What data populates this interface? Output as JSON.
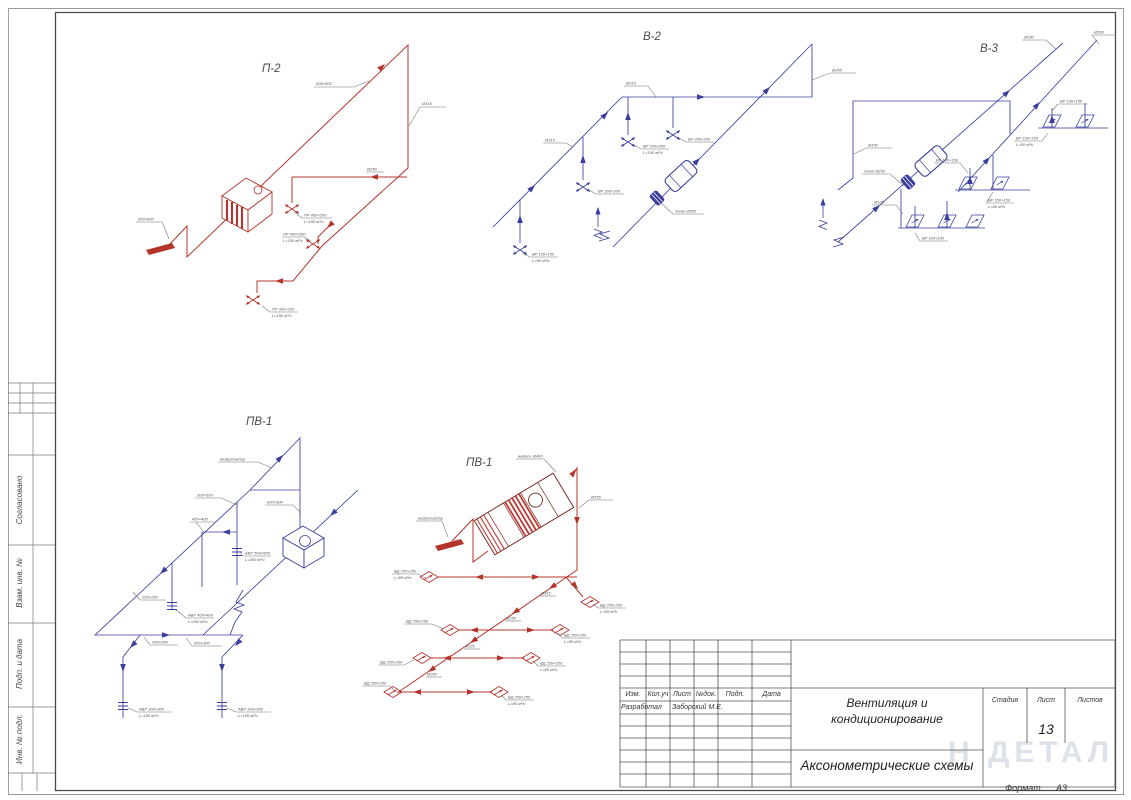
{
  "sheet": {
    "watermark": "Н ДЕТАЛ",
    "format_label": "Формат",
    "format_value": "А3"
  },
  "left_strip": {
    "soglasovano": "Согласовано",
    "vzam_inv": "Взам. инв. №",
    "podp_data": "Подп. и дата",
    "inv_podl": "Инв. № подл."
  },
  "title_block": {
    "rev_headers": [
      "Изм.",
      "Кол.уч",
      "Лист",
      "№док.",
      "Подп.",
      "Дата"
    ],
    "developer_label": "Разработал",
    "developer_name": "Заборский М.Е.",
    "doc_title_line1": "Вентиляция и",
    "doc_title_line2": "кондиционирование",
    "doc_subtitle": "Аксонометрические схемы",
    "stage_label": "Стадия",
    "sheet_label": "Лист",
    "sheets_label": "Листов",
    "sheet_number": "13"
  },
  "colors": {
    "supply_red": "#b5342c",
    "exhaust_blue": "#3a3f9e"
  },
  "diagrams": {
    "p2": {
      "title": "П-2",
      "labels": [
        "600×600",
        "Ø315",
        "ПР 400×200",
        "L=150 м³/ч",
        "ПР 400×200",
        "L=150 м³/ч",
        "600×600",
        "ПР 300×150",
        "L=150 м³/ч",
        "Ø250"
      ]
    },
    "v2": {
      "title": "В-2",
      "labels": [
        "Ø355",
        "Ø315",
        "ВР 150×150",
        "L=50 м³/ч",
        "ВР 200×200",
        "ВР 200×200",
        "L=100 м³/ч",
        "ВР 200×200",
        "Зонт Ø355"
      ]
    },
    "v3": {
      "title": "В-3",
      "labels": [
        "Ø250",
        "Ø200",
        "Зонт Ø250",
        "Ø160",
        "ВР 150×150",
        "ВР 150×150",
        "L=50 м³/ч",
        "ВР 150×150",
        "ВР 150×150",
        "L=50 м³/ч",
        "Ø125",
        "ВР 100×100"
      ]
    },
    "pv1": {
      "title": "ПВ-1",
      "labels": [
        "воздухозабор",
        "600×600",
        "500×500",
        "400×400",
        "АВР 500×500",
        "L=400 м³/ч",
        "АВР 400×400",
        "L=250 м³/ч",
        "300×300",
        "500×300",
        "250×250",
        "АВР 300×300",
        "L=150 м³/ч",
        "АВР 300×300",
        "L=150 м³/ч"
      ]
    },
    "pv1r": {
      "title": "ПВ-1",
      "labels": [
        "выброс Ø400",
        "Ø355",
        "воздухозабор",
        "Ø315",
        "Ø250",
        "Ø225",
        "Ø200",
        "ВД 250×250",
        "L=85 м³/ч",
        "ВД 250×250",
        "L=85 м³/ч",
        "ВД 250×250",
        "ВД 250×250",
        "L=85 м³/ч",
        "ВД 250×250",
        "ВД 250×250",
        "L=85 м³/ч",
        "ВД 250×250",
        "ВД 250×250",
        "L=85 м³/ч"
      ]
    }
  }
}
